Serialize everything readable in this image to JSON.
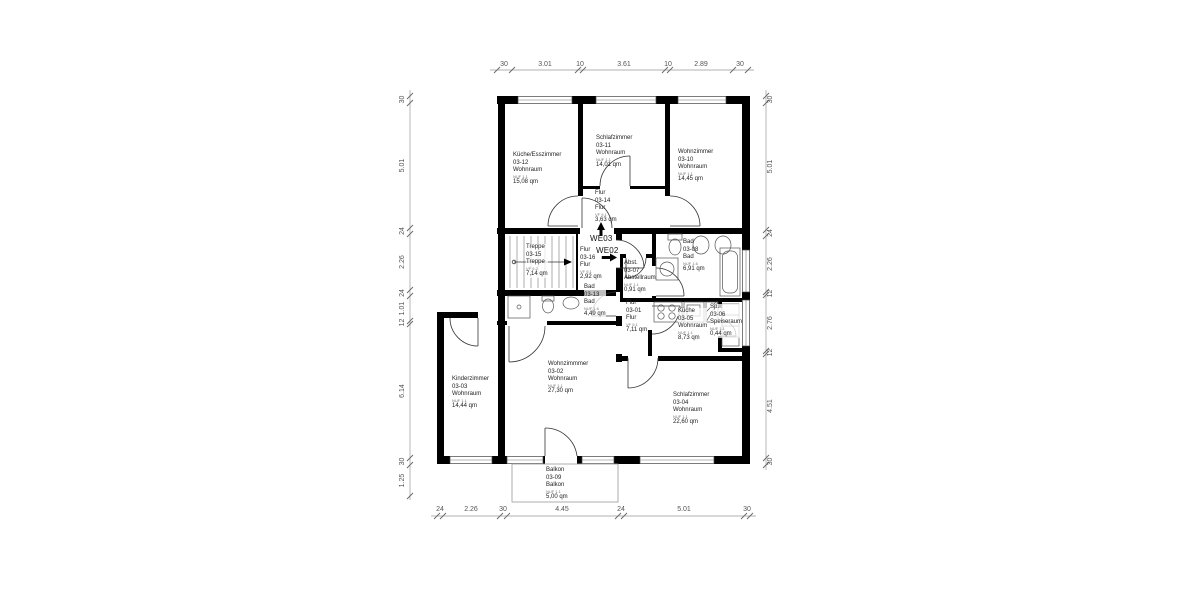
{
  "title": "Grundriss Obergeschoss WE02 / WE03",
  "apartments": {
    "we03": "WE03",
    "we02": "WE02"
  },
  "rooms": {
    "r0312": {
      "name": "Küche/Esszimmer",
      "number": "03-12",
      "type": "Wohnraum",
      "code": "NUF 1.1",
      "area": "15,08 qm"
    },
    "r0311": {
      "name": "Schlafzimmer",
      "number": "03-11",
      "type": "Wohnraum",
      "code": "NUF 1.1",
      "area": "14,01 qm"
    },
    "r0310": {
      "name": "Wohnzimmer",
      "number": "03-10",
      "type": "Wohnraum",
      "code": "NUF 1.1",
      "area": "14,45 qm"
    },
    "r0314": {
      "name": "Flur",
      "number": "03-14",
      "type": "Flur",
      "code": "VF 9.1",
      "area": "3,63 qm"
    },
    "r0315": {
      "name": "Treppe",
      "number": "03-15",
      "type": "Treppe",
      "code": "VF 9.2",
      "area": "7,14 qm"
    },
    "r0316": {
      "name": "Flur",
      "number": "03-16",
      "type": "Flur",
      "code": "VF 9.1",
      "area": "2,92 qm"
    },
    "r0307": {
      "name": "Abst.",
      "number": "03-07",
      "type": "Abstellraum",
      "code": "NUF 1.1",
      "area": "0,91 qm"
    },
    "r0308": {
      "name": "Bad",
      "number": "03-08",
      "type": "Bad",
      "code": "NUF 1.6",
      "area": "6,91 qm"
    },
    "r0313": {
      "name": "Bad",
      "number": "03-13",
      "type": "Bad",
      "code": "NUF 1.6",
      "area": "4,49 qm"
    },
    "r0301": {
      "name": "Flur",
      "number": "03-01",
      "type": "Flur",
      "code": "VF 9.1",
      "area": "7,11 qm"
    },
    "r0305": {
      "name": "Küche",
      "number": "03-05",
      "type": "Wohnraum",
      "code": "NUF 1.1",
      "area": "8,73 qm"
    },
    "r0306": {
      "name": "Sp.",
      "number": "03-06",
      "type": "Speiseraum",
      "code": "NUF 1.1",
      "area": "0,44 qm"
    },
    "r0303": {
      "name": "Kinderzimmer",
      "number": "03-03",
      "type": "Wohnraum",
      "code": "NUF 1.1",
      "area": "14,44 qm"
    },
    "r0302": {
      "name": "Wohnzimmmer",
      "number": "03-02",
      "type": "Wohnraum",
      "code": "NUF 1.1",
      "area": "27,30 qm"
    },
    "r0304": {
      "name": "Schlafzimmer",
      "number": "03-04",
      "type": "Wohnraum",
      "code": "NUF 1.1",
      "area": "22,60 qm"
    },
    "r0309": {
      "name": "Balkon",
      "number": "03-09",
      "type": "Balkon",
      "code": "NUF 1.1",
      "area": "5,00 qm"
    }
  },
  "dimensions": {
    "top": [
      "30",
      "3.01",
      "10",
      "3.61",
      "10",
      "2.89",
      "30"
    ],
    "bottom": [
      "24",
      "2.26",
      "30",
      "4.45",
      "24",
      "5.01",
      "30"
    ],
    "left": [
      "30",
      "5.01",
      "24",
      "2.26",
      "24",
      "1.01",
      "12",
      "6.14",
      "30",
      "1.25"
    ],
    "right": [
      "30",
      "5.01",
      "24",
      "2.26",
      "12",
      "2.76",
      "12",
      "4.51",
      "30"
    ]
  },
  "colors": {
    "wall": "#000000",
    "dim_text": "#555555",
    "label_text": "#222222",
    "thin_line": "#999999"
  }
}
